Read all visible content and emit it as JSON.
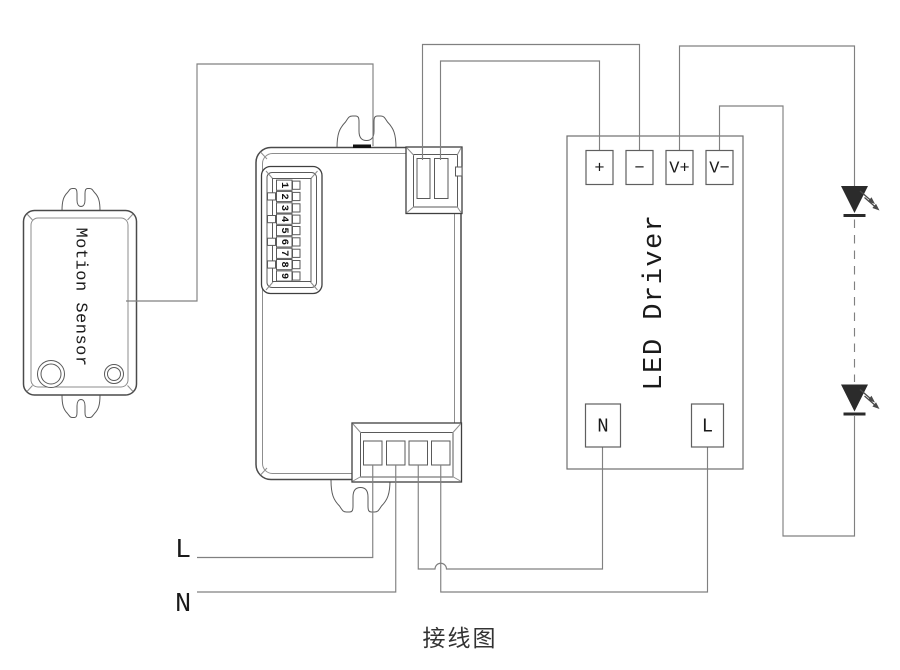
{
  "diagram": {
    "caption": "接线图"
  },
  "motion_sensor": {
    "label": "Motion Sensor"
  },
  "controller": {
    "dip_digits": [
      "1",
      "2",
      "3",
      "4",
      "5",
      "6",
      "7",
      "8",
      "9"
    ]
  },
  "led_driver": {
    "label": "LED Driver",
    "terminals": {
      "plus": "+",
      "minus": "−",
      "v_plus": "V+",
      "v_minus": "V−",
      "neutral": "N",
      "live": "L"
    }
  },
  "mains": {
    "live": "L",
    "neutral": "N"
  },
  "colors": {
    "wire": "#808080",
    "outline": "#4a4a4a",
    "text": "#1a1a1a",
    "led": "#2b2b2b"
  }
}
